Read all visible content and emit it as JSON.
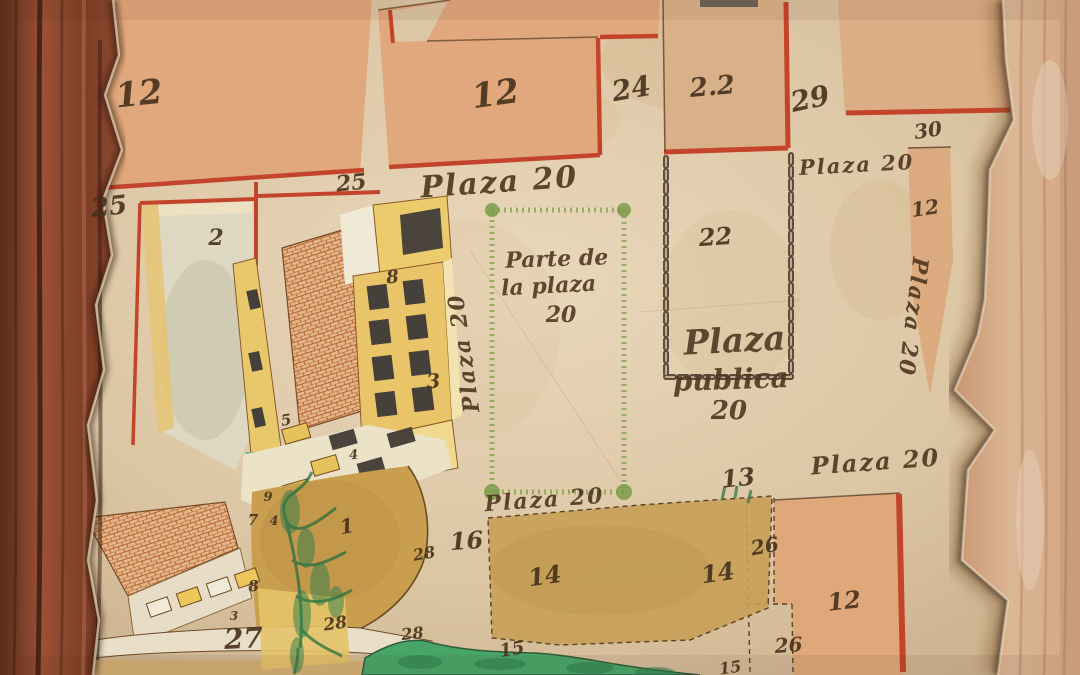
{
  "map": {
    "description": "Antique hand-drawn plat map of plaza and numbered lots on torn parchment over wood",
    "palette": {
      "parchment": "#dcc6a4",
      "parcel_salmon": "#e0a87c",
      "parcel_tan": "#d9b189",
      "parcel_ochre": "#c99e4f",
      "boundary_red": "#c4432b",
      "ink_brown": "#46301c",
      "plaza_green_border": "#85a352",
      "water_green": "#48a568",
      "building_yellow": "#e9c86b",
      "brick_orange": "#c4713a",
      "wood_frame_left": "#8a4a33",
      "wood_surface_right": "#d0a384",
      "chain_ink": "#47362a"
    },
    "labels": [
      {
        "text": "Plaza 20",
        "x": 500,
        "y": 192,
        "s": 30,
        "r": -4,
        "k": "street"
      },
      {
        "text": "Plaza 20",
        "x": 857,
        "y": 172,
        "s": 21,
        "r": -3,
        "k": "street"
      },
      {
        "text": "Plaza 20",
        "x": 906,
        "y": 316,
        "s": 22,
        "r": 97,
        "k": "street"
      },
      {
        "text": "Plaza 20",
        "x": 471,
        "y": 352,
        "s": 22,
        "r": -98,
        "k": "street"
      },
      {
        "text": "Plaza 20",
        "x": 545,
        "y": 507,
        "s": 22,
        "r": -4,
        "k": "street"
      },
      {
        "text": "Plaza 20",
        "x": 876,
        "y": 470,
        "s": 24,
        "r": -4,
        "k": "street"
      },
      {
        "text": "Parte de",
        "x": 557,
        "y": 266,
        "s": 22,
        "r": -2,
        "k": "note"
      },
      {
        "text": "la plaza",
        "x": 549,
        "y": 293,
        "s": 22,
        "r": -3,
        "k": "note"
      },
      {
        "text": "20",
        "x": 561,
        "y": 322,
        "s": 22,
        "r": 0,
        "k": "note"
      },
      {
        "text": "Plaza",
        "x": 735,
        "y": 352,
        "s": 34,
        "r": -3,
        "k": "note"
      },
      {
        "text": "publica",
        "x": 731,
        "y": 389,
        "s": 28,
        "r": -2,
        "k": "note"
      },
      {
        "text": "20",
        "x": 729,
        "y": 419,
        "s": 26,
        "r": 0,
        "k": "note"
      },
      {
        "text": "12",
        "x": 140,
        "y": 105,
        "s": 34,
        "r": -6,
        "k": "num"
      },
      {
        "text": "12",
        "x": 497,
        "y": 105,
        "s": 34,
        "r": -8,
        "k": "num"
      },
      {
        "text": "24",
        "x": 633,
        "y": 98,
        "s": 28,
        "r": -10,
        "k": "num"
      },
      {
        "text": "2.2",
        "x": 713,
        "y": 95,
        "s": 26,
        "r": -5,
        "k": "num"
      },
      {
        "text": "29",
        "x": 812,
        "y": 108,
        "s": 28,
        "r": -12,
        "k": "num"
      },
      {
        "text": "30",
        "x": 929,
        "y": 137,
        "s": 20,
        "r": -8,
        "k": "num"
      },
      {
        "text": "12",
        "x": 926,
        "y": 215,
        "s": 20,
        "r": -8,
        "k": "num"
      },
      {
        "text": "25",
        "x": 110,
        "y": 215,
        "s": 26,
        "r": -6,
        "k": "num"
      },
      {
        "text": "25",
        "x": 352,
        "y": 190,
        "s": 22,
        "r": -6,
        "k": "num"
      },
      {
        "text": "2",
        "x": 216,
        "y": 245,
        "s": 22,
        "r": 0,
        "k": "num"
      },
      {
        "text": "8",
        "x": 393,
        "y": 283,
        "s": 18,
        "r": -5,
        "k": "num"
      },
      {
        "text": "22",
        "x": 716,
        "y": 245,
        "s": 24,
        "r": -4,
        "k": "num"
      },
      {
        "text": "3",
        "x": 434,
        "y": 388,
        "s": 20,
        "r": -5,
        "k": "num"
      },
      {
        "text": "5",
        "x": 287,
        "y": 425,
        "s": 15,
        "r": -10,
        "k": "num"
      },
      {
        "text": "4",
        "x": 354,
        "y": 459,
        "s": 13,
        "r": -5,
        "k": "num"
      },
      {
        "text": "9",
        "x": 268,
        "y": 501,
        "s": 13,
        "r": 0,
        "k": "num"
      },
      {
        "text": "7",
        "x": 253,
        "y": 525,
        "s": 15,
        "r": 0,
        "k": "num"
      },
      {
        "text": "4",
        "x": 274,
        "y": 525,
        "s": 13,
        "r": 0,
        "k": "num"
      },
      {
        "text": "1",
        "x": 348,
        "y": 533,
        "s": 20,
        "r": -10,
        "k": "num"
      },
      {
        "text": "13",
        "x": 739,
        "y": 486,
        "s": 24,
        "r": -6,
        "k": "num"
      },
      {
        "text": "16",
        "x": 467,
        "y": 549,
        "s": 24,
        "r": -4,
        "k": "num"
      },
      {
        "text": "28",
        "x": 425,
        "y": 559,
        "s": 16,
        "r": -10,
        "k": "num"
      },
      {
        "text": "8",
        "x": 254,
        "y": 591,
        "s": 15,
        "r": -5,
        "k": "num"
      },
      {
        "text": "14",
        "x": 546,
        "y": 584,
        "s": 24,
        "r": -8,
        "k": "num"
      },
      {
        "text": "14",
        "x": 719,
        "y": 581,
        "s": 24,
        "r": -8,
        "k": "num"
      },
      {
        "text": "26",
        "x": 766,
        "y": 553,
        "s": 20,
        "r": -10,
        "k": "num"
      },
      {
        "text": "26",
        "x": 789,
        "y": 652,
        "s": 20,
        "r": -4,
        "k": "num"
      },
      {
        "text": "12",
        "x": 845,
        "y": 609,
        "s": 24,
        "r": -6,
        "k": "num"
      },
      {
        "text": "3",
        "x": 234,
        "y": 620,
        "s": 12,
        "r": 0,
        "k": "num"
      },
      {
        "text": "27",
        "x": 244,
        "y": 648,
        "s": 28,
        "r": -3,
        "k": "num"
      },
      {
        "text": "28",
        "x": 336,
        "y": 629,
        "s": 17,
        "r": -8,
        "k": "num"
      },
      {
        "text": "28",
        "x": 413,
        "y": 639,
        "s": 16,
        "r": -6,
        "k": "num"
      },
      {
        "text": "15",
        "x": 513,
        "y": 655,
        "s": 18,
        "r": -10,
        "k": "num"
      },
      {
        "text": "15",
        "x": 731,
        "y": 673,
        "s": 16,
        "r": -8,
        "k": "num"
      }
    ]
  }
}
